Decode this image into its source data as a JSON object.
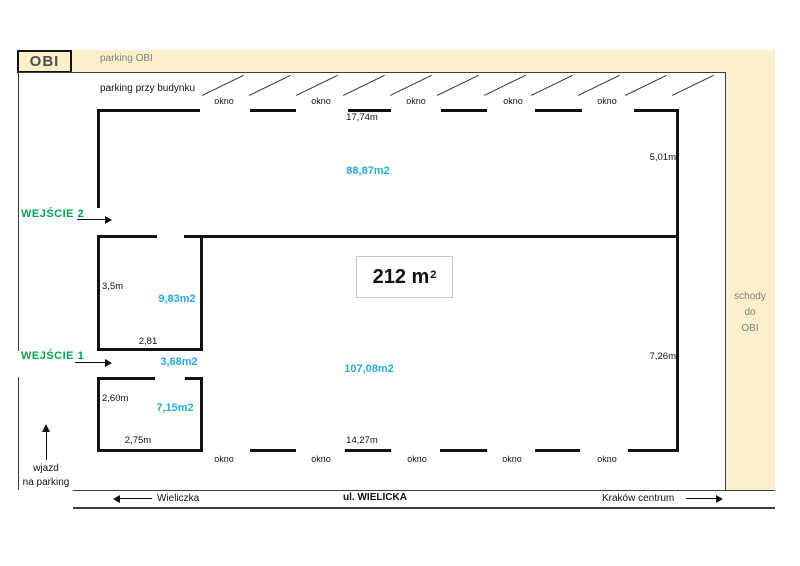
{
  "title_block": {
    "obi": "OBI",
    "parking_obi": "parking OBI",
    "parking_building": "parking przy budynku",
    "stairs": [
      "schody",
      "do",
      "OBI"
    ]
  },
  "windows": {
    "label": "okno"
  },
  "entrances": {
    "e2": "WEJŚCIE 2",
    "e1": "WEJŚCIE 1"
  },
  "areas": {
    "upper": "88,87m2",
    "room_top": "9,83m2",
    "corridor": "3,68m2",
    "room_bottom": "7,15m2",
    "lower": "107,08m2",
    "total": "212 m",
    "total_sup": "2"
  },
  "dimensions": {
    "top_width": "17,74m",
    "upper_right_height": "5,01m",
    "room_top_height": "3,5m",
    "room_top_width": "2,81",
    "room_bottom_height": "2,60m",
    "room_bottom_width": "2,75m",
    "bottom_width": "14,27m",
    "lower_right_height": "7,26m"
  },
  "driveway": [
    "wjazd",
    "na parking"
  ],
  "street": {
    "west": "Wieliczka",
    "name": "ul. WIELICKA",
    "east": "Kraków centrum"
  },
  "colors": {
    "beige": "#FBEFC9",
    "cyan": "#29ABE2",
    "green": "#00A651",
    "gray_text": "#808080",
    "wall": "#111111"
  },
  "parking_stripes": 11
}
